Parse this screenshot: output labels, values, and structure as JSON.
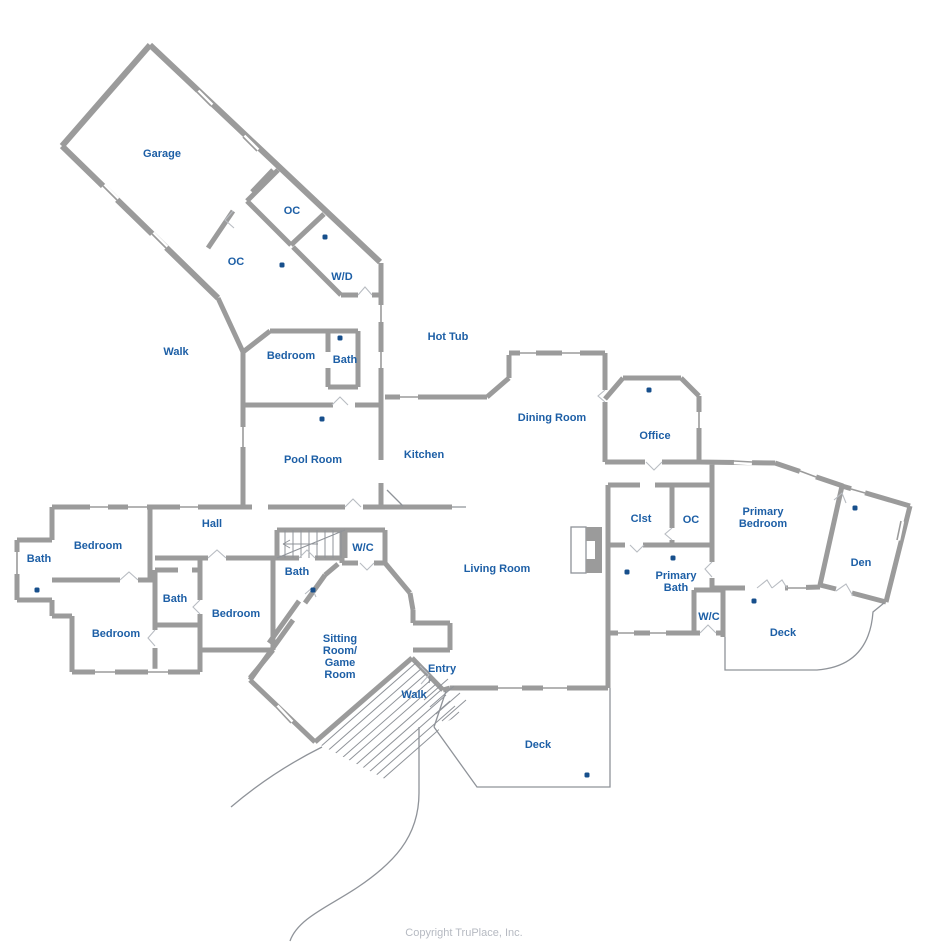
{
  "page": {
    "width": 932,
    "height": 949,
    "background": "#ffffff"
  },
  "colors": {
    "wall_gray": "#9b9b9b",
    "thin_line_gray": "#8f9399",
    "room_label_blue": "#1d5fa6",
    "photo_dot_blue": "#174f8c",
    "copyright_gray": "#b6bac2"
  },
  "floorplan": {
    "rooms": [
      {
        "id": "garage",
        "label": "Garage",
        "x": 162,
        "y": 154
      },
      {
        "id": "oc-upper",
        "label": "OC",
        "x": 292,
        "y": 211
      },
      {
        "id": "oc-lower",
        "label": "OC",
        "x": 236,
        "y": 262
      },
      {
        "id": "wd",
        "label": "W/D",
        "x": 342,
        "y": 277
      },
      {
        "id": "walk-upper",
        "label": "Walk",
        "x": 176,
        "y": 352
      },
      {
        "id": "bedroom-upper",
        "label": "Bedroom",
        "x": 291,
        "y": 356
      },
      {
        "id": "bath-upper",
        "label": "Bath",
        "x": 345,
        "y": 360
      },
      {
        "id": "hot-tub",
        "label": "Hot Tub",
        "x": 448,
        "y": 337
      },
      {
        "id": "pool-room",
        "label": "Pool Room",
        "x": 313,
        "y": 460
      },
      {
        "id": "kitchen",
        "label": "Kitchen",
        "x": 424,
        "y": 455
      },
      {
        "id": "dining-room",
        "label": "Dining Room",
        "x": 552,
        "y": 418
      },
      {
        "id": "office",
        "label": "Office",
        "x": 655,
        "y": 436
      },
      {
        "id": "hall",
        "label": "Hall",
        "x": 212,
        "y": 524
      },
      {
        "id": "bath-far-left",
        "label": "Bath",
        "x": 39,
        "y": 559
      },
      {
        "id": "bedroom-left-1",
        "label": "Bedroom",
        "x": 98,
        "y": 546
      },
      {
        "id": "bedroom-left-2",
        "label": "Bedroom",
        "x": 116,
        "y": 634
      },
      {
        "id": "bath-mid",
        "label": "Bath",
        "x": 175,
        "y": 599
      },
      {
        "id": "bedroom-center",
        "label": "Bedroom",
        "x": 236,
        "y": 614
      },
      {
        "id": "bath-sitting",
        "label": "Bath",
        "x": 297,
        "y": 572
      },
      {
        "id": "wc-left",
        "label": "W/C",
        "x": 363,
        "y": 548
      },
      {
        "id": "living-room",
        "label": "Living Room",
        "x": 497,
        "y": 569
      },
      {
        "id": "clst",
        "label": "Clst",
        "x": 641,
        "y": 519
      },
      {
        "id": "oc-right",
        "label": "OC",
        "x": 691,
        "y": 520
      },
      {
        "id": "primary-bedroom",
        "label": "Primary\nBedroom",
        "x": 763,
        "y": 518
      },
      {
        "id": "primary-bath",
        "label": "Primary\nBath",
        "x": 676,
        "y": 582
      },
      {
        "id": "den",
        "label": "Den",
        "x": 861,
        "y": 563
      },
      {
        "id": "wc-right",
        "label": "W/C",
        "x": 709,
        "y": 617
      },
      {
        "id": "deck-right",
        "label": "Deck",
        "x": 783,
        "y": 633
      },
      {
        "id": "sitting-game-room",
        "label": "Sitting\nRoom/\nGame\nRoom",
        "x": 340,
        "y": 657
      },
      {
        "id": "entry",
        "label": "Entry",
        "x": 442,
        "y": 669
      },
      {
        "id": "walk-lower",
        "label": "Walk",
        "x": 414,
        "y": 695
      },
      {
        "id": "deck-bottom",
        "label": "Deck",
        "x": 538,
        "y": 745
      }
    ],
    "photo_points": [
      {
        "x": 325,
        "y": 237
      },
      {
        "x": 282,
        "y": 265
      },
      {
        "x": 340,
        "y": 338
      },
      {
        "x": 322,
        "y": 419
      },
      {
        "x": 649,
        "y": 390
      },
      {
        "x": 37,
        "y": 590
      },
      {
        "x": 313,
        "y": 590
      },
      {
        "x": 673,
        "y": 558
      },
      {
        "x": 627,
        "y": 572
      },
      {
        "x": 754,
        "y": 601
      },
      {
        "x": 855,
        "y": 508
      },
      {
        "x": 587,
        "y": 775
      }
    ]
  },
  "footer": {
    "copyright": "Copyright  TruPlace, Inc."
  }
}
